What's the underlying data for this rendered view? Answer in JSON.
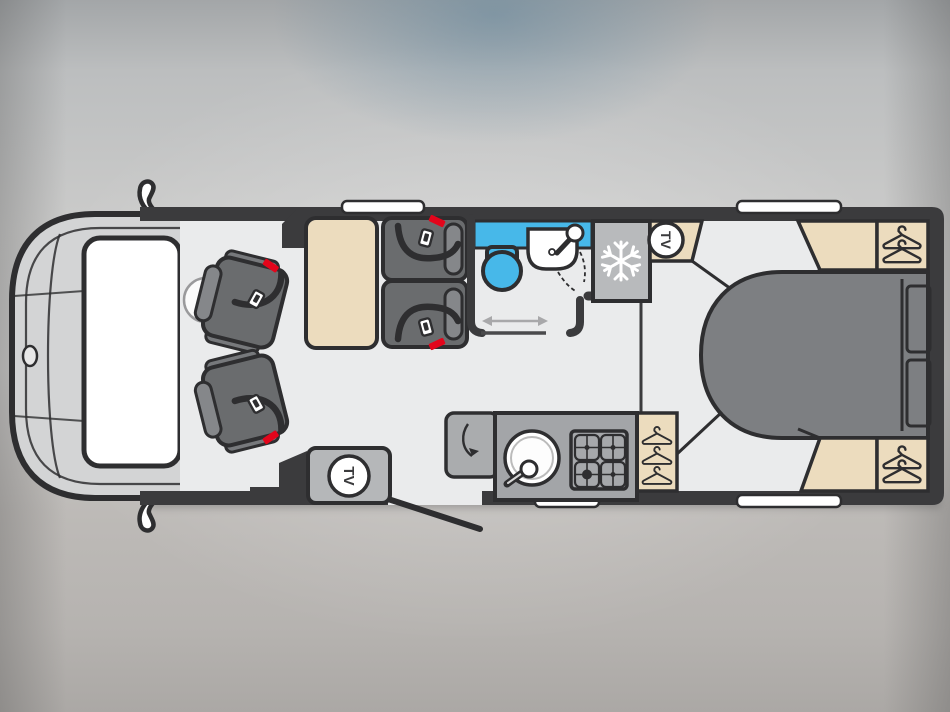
{
  "floorplan": {
    "tv_badge": {
      "label": "TV"
    },
    "colors": {
      "wall": "#3b3b3d",
      "floor": "#eaebec",
      "cab_body": "#d3d4d5",
      "windscreen": "#ffffff",
      "window": "#ffffff",
      "seat": "#6a6c6e",
      "seat_cushion": "#85878a",
      "furniture_beige": "#ecdcbe",
      "bed": "#7d7f82",
      "kitchen_unit": "#a3a5a8",
      "worktop_flap": "#aaacae",
      "fridge": "#b8babc",
      "tv_unit": "#b5b7b9",
      "accent_blue": "#47b8e9",
      "seatbelt_red": "#e3051b",
      "slide_arrow": "#a8a8aa"
    },
    "icons": {
      "fridge": "snowflake-icon",
      "wardrobe": "hanger-icon",
      "tv": "tv-badge-circle",
      "seatbelt": "seatbelt-buckle-icon",
      "washroom_door": "slide-arrow-icon",
      "worktop_flap": "fold-arrow-icon"
    }
  }
}
